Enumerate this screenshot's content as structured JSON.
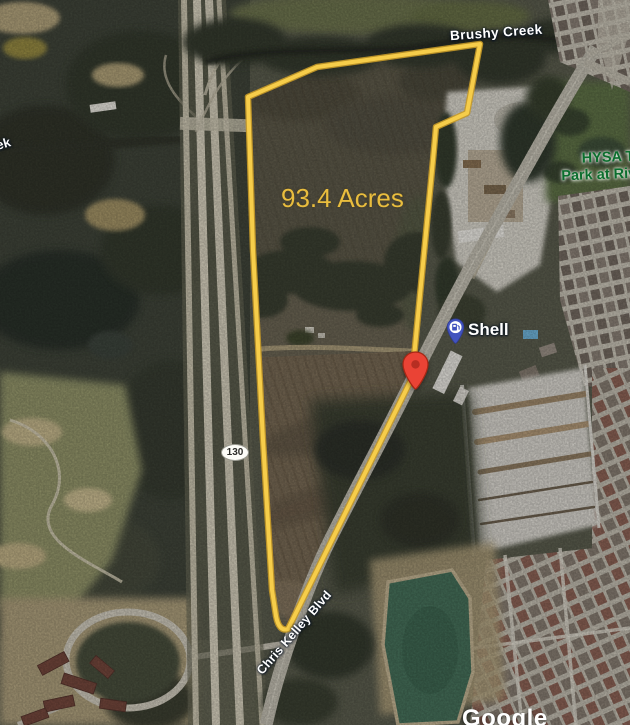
{
  "map": {
    "labels": {
      "creek": "Brushy Creek",
      "creek_partial": "ek",
      "acreage": "93.4 Acres",
      "park_line1": "HYSA T",
      "park_line2": "Park at Riv",
      "gas_station": "Shell",
      "highway_shield": "130",
      "road": "Chris Kelley Blvd",
      "watermark": "Google"
    },
    "colors": {
      "boundary_yellow": "#F2C53D",
      "acreage_text": "#E9BD3E",
      "marker_red": "#EA4335",
      "gas_pin_blue": "#4253BE",
      "park_text_green": "#0C6E2E",
      "pond_green": "#46705A",
      "label_text_white": "#FFFFFF"
    }
  }
}
